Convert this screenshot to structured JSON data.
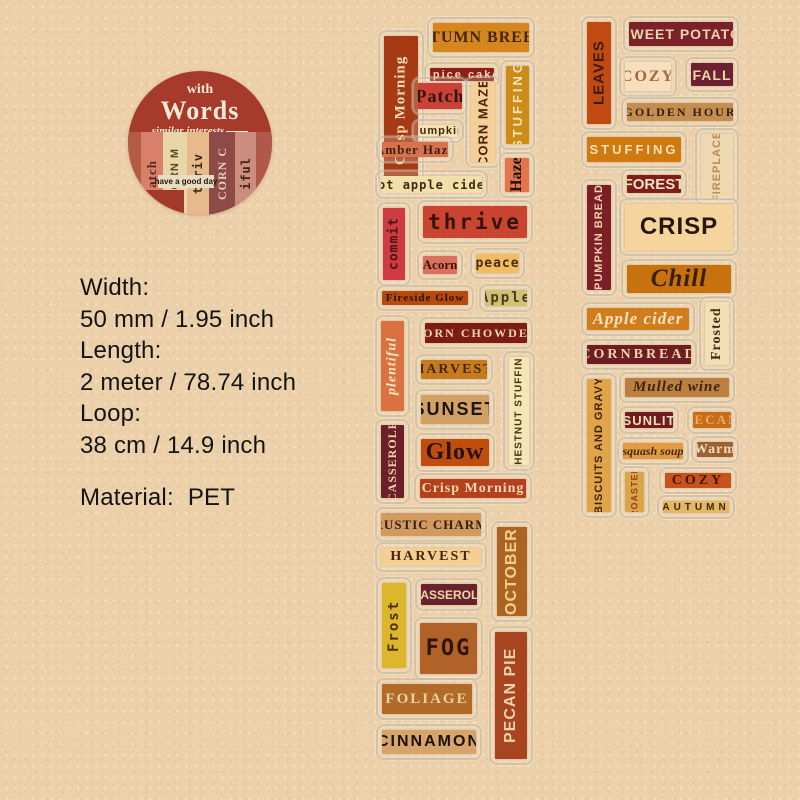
{
  "page": {
    "background": "#ecd0aa"
  },
  "badge": {
    "bg": "#a63b2b",
    "small_word": "with",
    "big_word": "Words",
    "tagline": "similar interests",
    "tag_text": "have a good day",
    "collage": [
      {
        "text": "",
        "bg": "#b55b43",
        "fg": "#b55b43",
        "w": 13,
        "font": "serif",
        "size": 11
      },
      {
        "text": "atch",
        "bg": "#d8806a",
        "fg": "#5a2820",
        "w": 22,
        "font": "serif",
        "size": 13
      },
      {
        "text": "CORN M",
        "bg": "#e9d6a8",
        "fg": "#5a4a28",
        "w": 24,
        "font": "sans",
        "size": 11
      },
      {
        "text": "thriv",
        "bg": "#e9b98e",
        "fg": "#3a2a1a",
        "w": 22,
        "font": "mono",
        "size": 12
      },
      {
        "text": "CORN C",
        "bg": "#8d4a47",
        "fg": "#e8d0b8",
        "w": 26,
        "font": "serif",
        "size": 12
      },
      {
        "text": "iful",
        "bg": "#cc8d7e",
        "fg": "#44221c",
        "w": 21,
        "font": "mono",
        "size": 12
      },
      {
        "text": "",
        "bg": "#b0584a",
        "fg": "#b0584a",
        "w": 16,
        "font": "serif",
        "size": 11
      }
    ]
  },
  "specs": {
    "lines": [
      "Width:",
      "50 mm / 1.95 inch",
      "Length:",
      "2 meter / 78.74 inch",
      "Loop:",
      "38 cm / 14.9 inch"
    ],
    "material_label": "Material:",
    "material_value": "PET"
  },
  "strips": [
    {
      "name": "tape-strip-1",
      "stickers": [
        {
          "id": "crisp-morning-vertical",
          "label": "Crisp Morning",
          "x": 378,
          "y": 30,
          "w": 46,
          "h": 160,
          "bg": "#a63a15",
          "fg": "#f3ddb4",
          "font": "serif",
          "size": 15,
          "ls": 1,
          "v": true
        },
        {
          "id": "autumn-breeze",
          "label": "AUTUMN BREEZE",
          "x": 427,
          "y": 17,
          "w": 108,
          "h": 41,
          "bg": "#d6861e",
          "fg": "#43250e",
          "font": "serif",
          "size": 16,
          "ls": 1,
          "v": false
        },
        {
          "id": "spice-cake",
          "label": "Spice cake",
          "x": 424,
          "y": 62,
          "w": 76,
          "h": 25,
          "bg": "#8e1e17",
          "fg": "#f5d9b5",
          "font": "sans",
          "size": 11,
          "ls": 2,
          "v": false
        },
        {
          "id": "patch",
          "label": "Patch",
          "x": 412,
          "y": 77,
          "w": 56,
          "h": 38,
          "bg": "#cb4136",
          "fg": "#2e1711",
          "font": "serif",
          "size": 18,
          "ls": 1,
          "v": false
        },
        {
          "id": "corn-maze-vertical",
          "label": "CORN MAZE",
          "x": 465,
          "y": 76,
          "w": 36,
          "h": 92,
          "bg": "#f6cf97",
          "fg": "#43250e",
          "font": "sans",
          "size": 13,
          "ls": 1,
          "v": true
        },
        {
          "id": "stuffing-vertical",
          "label": "STUFFING",
          "x": 500,
          "y": 60,
          "w": 35,
          "h": 90,
          "bg": "#cd8c18",
          "fg": "#f3e3bd",
          "font": "sans",
          "size": 13,
          "ls": 3,
          "v": true
        },
        {
          "id": "pumpkin",
          "label": "Pumpkin",
          "x": 412,
          "y": 119,
          "w": 52,
          "h": 24,
          "bg": "#f8e1ad",
          "fg": "#402a12",
          "font": "sans",
          "size": 11,
          "ls": 1,
          "v": false
        },
        {
          "id": "amber-haze",
          "label": "Amber Haze",
          "x": 376,
          "y": 136,
          "w": 78,
          "h": 27,
          "bg": "#d8724d",
          "fg": "#3c1f10",
          "font": "serif",
          "size": 13,
          "ls": 1,
          "v": false
        },
        {
          "id": "haze-vertical",
          "label": "Haze",
          "x": 499,
          "y": 152,
          "w": 36,
          "h": 46,
          "bg": "#e4744c",
          "fg": "#1e1008",
          "font": "serif",
          "size": 16,
          "ls": 0,
          "v": true
        },
        {
          "id": "hot-apple-cider",
          "label": "Hot apple cider",
          "x": 375,
          "y": 170,
          "w": 113,
          "h": 29,
          "bg": "#f3dfa9",
          "fg": "#3d2a16",
          "font": "mono",
          "size": 12,
          "ls": 1,
          "v": false
        },
        {
          "id": "commit-vertical",
          "label": "commit",
          "x": 377,
          "y": 202,
          "w": 34,
          "h": 84,
          "bg": "#ce3b42",
          "fg": "#4c1511",
          "font": "mono",
          "size": 13,
          "ls": 1,
          "v": true
        },
        {
          "id": "thrive",
          "label": "thrive",
          "x": 417,
          "y": 200,
          "w": 116,
          "h": 44,
          "bg": "#c94532",
          "fg": "#38130b",
          "font": "mono",
          "size": 21,
          "ls": 3,
          "v": false
        },
        {
          "id": "acorn",
          "label": "Acorn",
          "x": 417,
          "y": 250,
          "w": 46,
          "h": 30,
          "bg": "#dd6f5e",
          "fg": "#3a140c",
          "font": "serif",
          "size": 13,
          "ls": 0,
          "v": false
        },
        {
          "id": "peace",
          "label": "peace",
          "x": 470,
          "y": 248,
          "w": 55,
          "h": 31,
          "bg": "#f0bc64",
          "fg": "#4a2c0f",
          "font": "mono",
          "size": 13,
          "ls": 1,
          "v": false
        },
        {
          "id": "fireside-glow",
          "label": "Fireside Glow",
          "x": 376,
          "y": 285,
          "w": 98,
          "h": 26,
          "bg": "#b54a0f",
          "fg": "#2a1406",
          "font": "serif",
          "size": 11,
          "ls": 1,
          "v": false
        },
        {
          "id": "apple",
          "label": "Apple",
          "x": 479,
          "y": 284,
          "w": 54,
          "h": 28,
          "bg": "#cfc176",
          "fg": "#4b3a14",
          "font": "mono",
          "size": 14,
          "ls": 2,
          "v": false
        },
        {
          "id": "plentiful-vertical",
          "label": "plentiful",
          "x": 375,
          "y": 315,
          "w": 35,
          "h": 102,
          "bg": "#d97140",
          "fg": "#f7e6c3",
          "font": "script",
          "size": 14,
          "ls": 1,
          "v": true
        },
        {
          "id": "corn-chowder",
          "label": "CORN CHOWDER",
          "x": 419,
          "y": 317,
          "w": 114,
          "h": 32,
          "bg": "#7c1d15",
          "fg": "#efd7ae",
          "font": "serif",
          "size": 12,
          "ls": 2,
          "v": false
        },
        {
          "id": "harvest-1",
          "label": "HARVEST",
          "x": 415,
          "y": 354,
          "w": 78,
          "h": 31,
          "bg": "#c77b1c",
          "fg": "#45260d",
          "font": "serif",
          "size": 14,
          "ls": 2,
          "v": false
        },
        {
          "id": "chestnut-stuffing-vertical",
          "label": "CHESTNUT STUFFING",
          "x": 503,
          "y": 351,
          "w": 32,
          "h": 120,
          "bg": "#f6e5b5",
          "fg": "#4a3212",
          "font": "sans",
          "size": 10,
          "ls": 1,
          "v": true
        },
        {
          "id": "sunset",
          "label": "SUNSET",
          "x": 415,
          "y": 389,
          "w": 80,
          "h": 41,
          "bg": "#d0a065",
          "fg": "#1d1410",
          "font": "sans",
          "size": 18,
          "ls": 2,
          "v": false
        },
        {
          "id": "glow",
          "label": "Glow",
          "x": 415,
          "y": 433,
          "w": 80,
          "h": 39,
          "bg": "#c04c0e",
          "fg": "#27120a",
          "font": "serif",
          "size": 24,
          "ls": 1,
          "v": false
        },
        {
          "id": "casserole-1-vertical",
          "label": "CASSEROLE",
          "x": 375,
          "y": 419,
          "w": 35,
          "h": 85,
          "bg": "#6d2029",
          "fg": "#eed3ad",
          "font": "serif",
          "size": 12,
          "ls": 1,
          "v": true
        },
        {
          "id": "crisp-morning-2",
          "label": "Crisp Morning",
          "x": 414,
          "y": 473,
          "w": 118,
          "h": 31,
          "bg": "#b4401e",
          "fg": "#f3d9ad",
          "font": "serif",
          "size": 14,
          "ls": 1,
          "v": false
        },
        {
          "id": "rustic-charm",
          "label": "RUSTIC CHARM",
          "x": 375,
          "y": 507,
          "w": 112,
          "h": 35,
          "bg": "#d09a60",
          "fg": "#37200e",
          "font": "serif",
          "size": 13,
          "ls": 1,
          "v": false
        },
        {
          "id": "october-vertical",
          "label": "OCTOBER",
          "x": 491,
          "y": 521,
          "w": 42,
          "h": 101,
          "bg": "#ad6321",
          "fg": "#f2cf8d",
          "font": "sans",
          "size": 16,
          "ls": 1,
          "v": true
        },
        {
          "id": "harvest-2",
          "label": "HARVEST",
          "x": 375,
          "y": 542,
          "w": 112,
          "h": 30,
          "bg": "#f4cf92",
          "fg": "#422810",
          "font": "serif",
          "size": 14,
          "ls": 2,
          "v": false
        },
        {
          "id": "frost-vertical",
          "label": "Frost",
          "x": 376,
          "y": 577,
          "w": 36,
          "h": 97,
          "bg": "#dcb62c",
          "fg": "#4c3210",
          "font": "mono",
          "size": 14,
          "ls": 2,
          "v": true
        },
        {
          "id": "casserole-2",
          "label": "CASSEROLE",
          "x": 415,
          "y": 578,
          "w": 68,
          "h": 33,
          "bg": "#65232b",
          "fg": "#eed3ad",
          "font": "sans",
          "size": 12,
          "ls": 0,
          "v": false
        },
        {
          "id": "fog",
          "label": "FOG",
          "x": 414,
          "y": 617,
          "w": 69,
          "h": 63,
          "bg": "#b06228",
          "fg": "#2e1508",
          "font": "mono",
          "size": 22,
          "ls": 2,
          "v": false
        },
        {
          "id": "pecan-pie-vertical",
          "label": "PECAN PIE",
          "x": 489,
          "y": 626,
          "w": 44,
          "h": 139,
          "bg": "#a8441f",
          "fg": "#ecd3a8",
          "font": "sans",
          "size": 16,
          "ls": 1,
          "v": true
        },
        {
          "id": "foliage",
          "label": "FOLIAGE",
          "x": 376,
          "y": 678,
          "w": 102,
          "h": 42,
          "bg": "#b26a29",
          "fg": "#ecd0a0",
          "font": "serif",
          "size": 15,
          "ls": 2,
          "v": false
        },
        {
          "id": "cinnamon",
          "label": "CINNAMON",
          "x": 376,
          "y": 724,
          "w": 106,
          "h": 36,
          "bg": "#d7a569",
          "fg": "#1c120a",
          "font": "sans",
          "size": 16,
          "ls": 2,
          "v": false
        }
      ]
    },
    {
      "name": "tape-strip-2",
      "stickers": [
        {
          "id": "leaves-vertical",
          "label": "LEAVES",
          "x": 581,
          "y": 16,
          "w": 36,
          "h": 114,
          "bg": "#c14a12",
          "fg": "#3c1c0b",
          "font": "sans",
          "size": 15,
          "ls": 1,
          "v": true
        },
        {
          "id": "sweet-potato",
          "label": "SWEET POTATO",
          "x": 623,
          "y": 16,
          "w": 116,
          "h": 36,
          "bg": "#7b212a",
          "fg": "#f0d3ac",
          "font": "sans",
          "size": 14,
          "ls": 1,
          "v": false
        },
        {
          "id": "cozy-1",
          "label": "COZY",
          "x": 619,
          "y": 56,
          "w": 58,
          "h": 41,
          "bg": "#f7debc",
          "fg": "#a06a3c",
          "font": "serif",
          "size": 16,
          "ls": 2,
          "v": false
        },
        {
          "id": "fall",
          "label": "FALL",
          "x": 685,
          "y": 57,
          "w": 54,
          "h": 35,
          "bg": "#6d2130",
          "fg": "#efd4ae",
          "font": "sans",
          "size": 14,
          "ls": 1,
          "v": false
        },
        {
          "id": "golden-hour",
          "label": "GOLDEN HOUR",
          "x": 621,
          "y": 97,
          "w": 118,
          "h": 30,
          "bg": "#c68d50",
          "fg": "#33200d",
          "font": "serif",
          "size": 12,
          "ls": 2,
          "v": false
        },
        {
          "id": "stuffing-2",
          "label": "STUFFING",
          "x": 581,
          "y": 131,
          "w": 106,
          "h": 37,
          "bg": "#d0790f",
          "fg": "#f6e0b7",
          "font": "sans",
          "size": 13,
          "ls": 3,
          "v": false
        },
        {
          "id": "fireplace-vertical",
          "label": "FIREPLACE",
          "x": 695,
          "y": 128,
          "w": 44,
          "h": 77,
          "bg": "#eed8b2",
          "fg": "#b98b55",
          "font": "sans",
          "size": 11,
          "ls": 1,
          "v": true
        },
        {
          "id": "forest",
          "label": "FOREST",
          "x": 621,
          "y": 169,
          "w": 66,
          "h": 30,
          "bg": "#7d1e1a",
          "fg": "#f3e2c8",
          "font": "sans",
          "size": 15,
          "ls": 0,
          "v": false
        },
        {
          "id": "pumpkin-bread-vertical",
          "label": "PUMPKIN BREAD",
          "x": 581,
          "y": 179,
          "w": 36,
          "h": 117,
          "bg": "#7c1f27",
          "fg": "#edd2ab",
          "font": "sans",
          "size": 11,
          "ls": 1,
          "v": true
        },
        {
          "id": "crisp",
          "label": "CRISP",
          "x": 619,
          "y": 198,
          "w": 120,
          "h": 58,
          "bg": "#f6d49e",
          "fg": "#26160b",
          "font": "sans",
          "size": 24,
          "ls": 1,
          "v": false
        },
        {
          "id": "chill",
          "label": "Chill",
          "x": 621,
          "y": 259,
          "w": 116,
          "h": 40,
          "bg": "#c8720f",
          "fg": "#3a1d0a",
          "font": "serif",
          "size": 25,
          "ls": 1,
          "v": false,
          "italic": true
        },
        {
          "id": "apple-cider",
          "label": "Apple cider",
          "x": 581,
          "y": 302,
          "w": 114,
          "h": 34,
          "bg": "#d07d1e",
          "fg": "#f7e3c0",
          "font": "script",
          "size": 17,
          "ls": 1,
          "v": false
        },
        {
          "id": "frosted-vertical",
          "label": "Frosted",
          "x": 699,
          "y": 296,
          "w": 36,
          "h": 75,
          "bg": "#f3dfb4",
          "fg": "#3f2a12",
          "font": "serif",
          "size": 14,
          "ls": 1,
          "v": true
        },
        {
          "id": "cornbread",
          "label": "CORNBREAD",
          "x": 581,
          "y": 339,
          "w": 116,
          "h": 31,
          "bg": "#6c1e23",
          "fg": "#eed3a8",
          "font": "serif",
          "size": 14,
          "ls": 3,
          "v": false
        },
        {
          "id": "biscuits-and-gravy-vertical",
          "label": "BISCUITS AND GRAVY",
          "x": 581,
          "y": 373,
          "w": 36,
          "h": 145,
          "bg": "#e0a44b",
          "fg": "#3f2408",
          "font": "sans",
          "size": 11,
          "ls": 1,
          "v": true
        },
        {
          "id": "mulled-wine",
          "label": "Mulled wine",
          "x": 619,
          "y": 372,
          "w": 116,
          "h": 31,
          "bg": "#ba7f41",
          "fg": "#3e2410",
          "font": "script",
          "size": 15,
          "ls": 1,
          "v": false
        },
        {
          "id": "sunlit",
          "label": "SUNLIT",
          "x": 619,
          "y": 406,
          "w": 60,
          "h": 28,
          "bg": "#701c20",
          "fg": "#f2ddb8",
          "font": "sans",
          "size": 13,
          "ls": 1,
          "v": false
        },
        {
          "id": "pecan",
          "label": "PECAN",
          "x": 687,
          "y": 406,
          "w": 50,
          "h": 28,
          "bg": "#c96c16",
          "fg": "#eaa869",
          "font": "serif",
          "size": 13,
          "ls": 2,
          "v": false
        },
        {
          "id": "squash-soup",
          "label": "squash soup",
          "x": 617,
          "y": 437,
          "w": 72,
          "h": 28,
          "bg": "#e19b41",
          "fg": "#452a0e",
          "font": "script",
          "size": 12,
          "ls": 0,
          "v": false
        },
        {
          "id": "warm",
          "label": "Warm",
          "x": 691,
          "y": 436,
          "w": 48,
          "h": 27,
          "bg": "#9d6034",
          "fg": "#f2dcb8",
          "font": "serif",
          "size": 14,
          "ls": 1,
          "v": false
        },
        {
          "id": "roasted-vertical",
          "label": "ROASTED",
          "x": 619,
          "y": 466,
          "w": 31,
          "h": 52,
          "bg": "#daa64a",
          "fg": "#9c3c1a",
          "font": "sans",
          "size": 9,
          "ls": 1,
          "v": true
        },
        {
          "id": "cozy-2",
          "label": "COZY",
          "x": 659,
          "y": 467,
          "w": 78,
          "h": 27,
          "bg": "#c8521b",
          "fg": "#3c1a0b",
          "font": "serif",
          "size": 14,
          "ls": 3,
          "v": false
        },
        {
          "id": "autumn",
          "label": "AUTUMN",
          "x": 657,
          "y": 495,
          "w": 78,
          "h": 24,
          "bg": "#e2b862",
          "fg": "#3e280e",
          "font": "sans",
          "size": 10,
          "ls": 4,
          "v": false
        }
      ]
    }
  ]
}
